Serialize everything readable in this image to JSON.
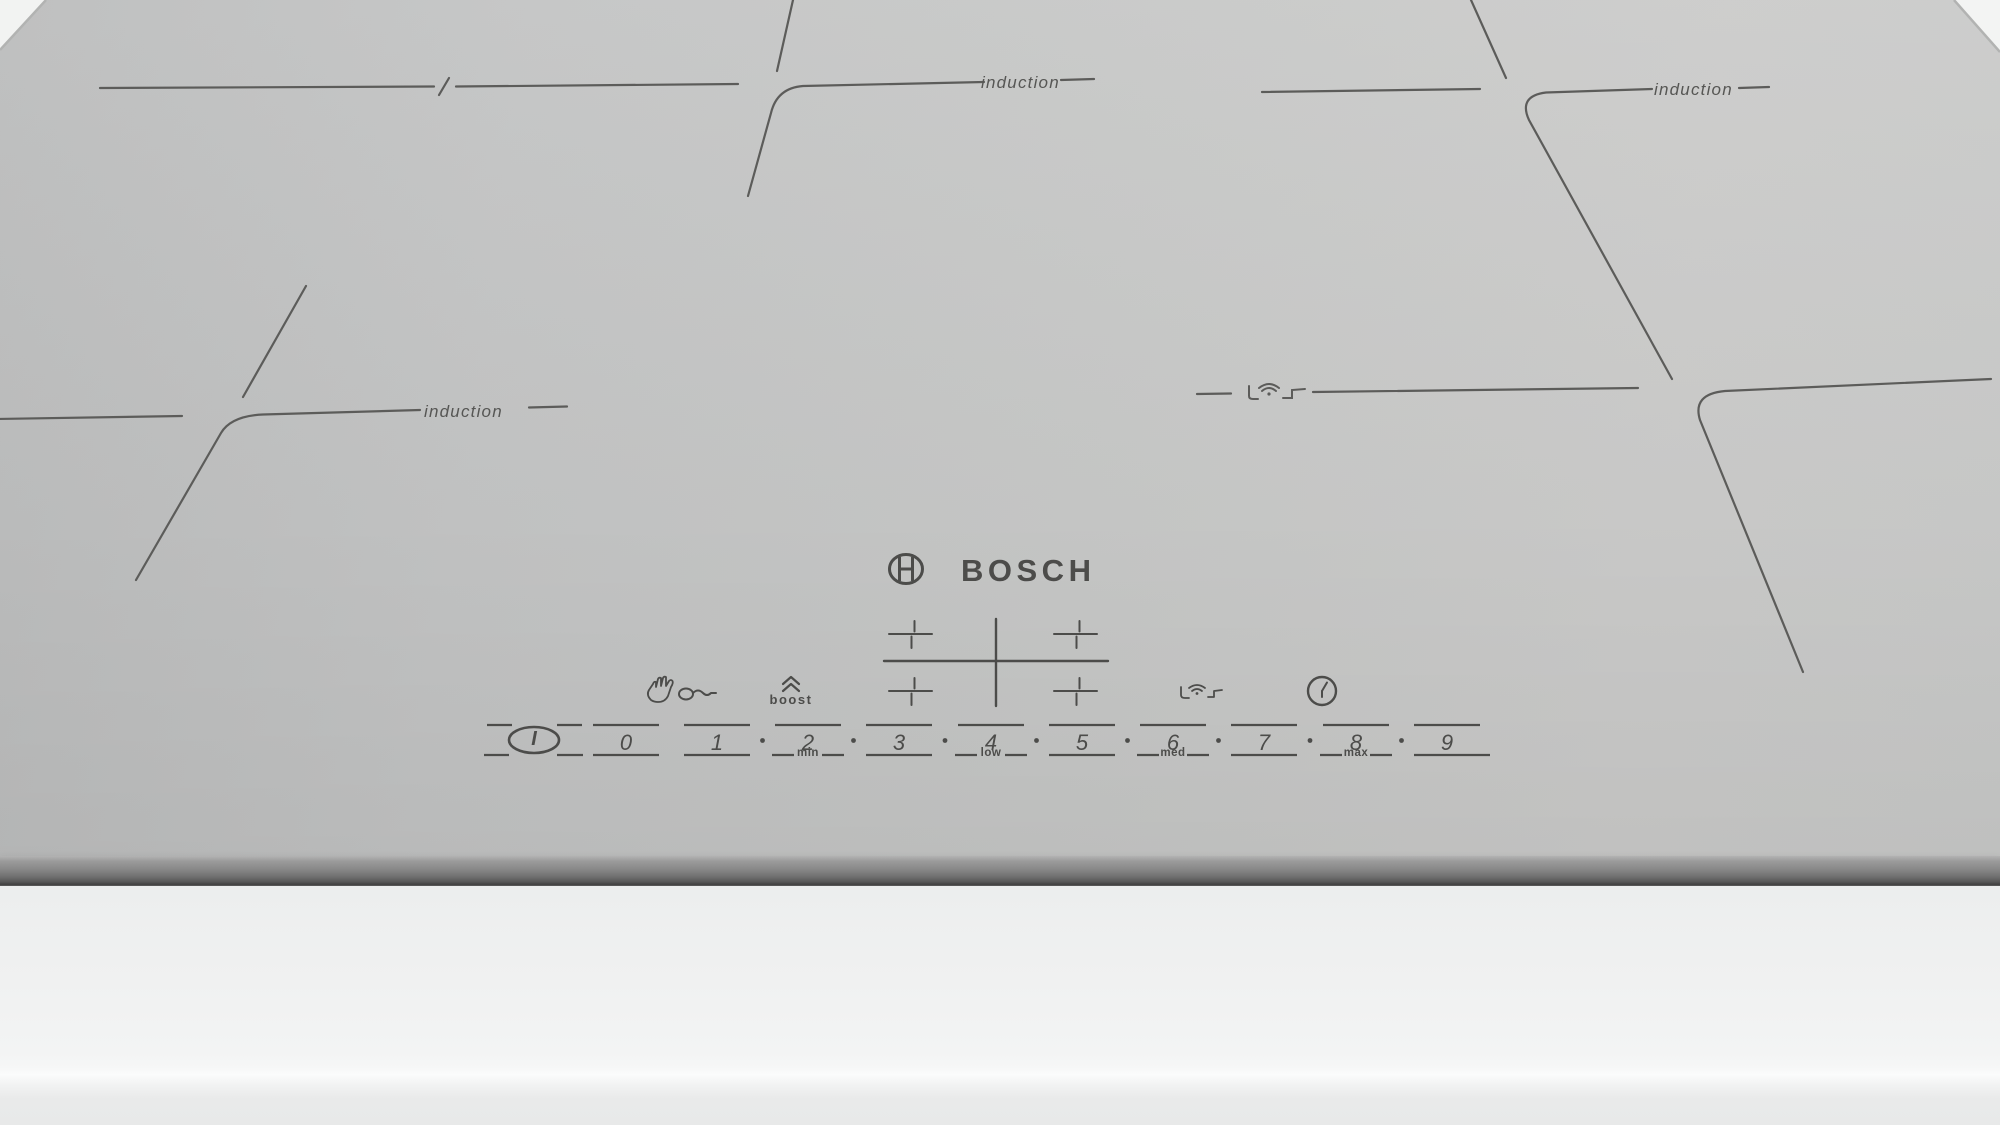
{
  "brand": {
    "name": "BOSCH"
  },
  "zones": {
    "labels": [
      "induction",
      "induction",
      "induction"
    ]
  },
  "controls": {
    "boost_label": "boost",
    "icon_names": [
      "hand-icon",
      "key-icon",
      "boost-chevrons-icon",
      "zone-select-cross",
      "pan-detection-icon",
      "timer-clock-icon",
      "flex-zone-pan-icon",
      "power-button"
    ]
  },
  "slider": {
    "power_label": "I",
    "digits": [
      "0",
      "1",
      "2",
      "3",
      "4",
      "5",
      "6",
      "7",
      "8",
      "9"
    ],
    "scale_labels": [
      "min",
      "low",
      "med",
      "max"
    ]
  },
  "colors": {
    "glass": "#c5c6c5",
    "marking": "#5c5c5a",
    "control": "#4c4c4a",
    "front_panel": "#f0f1f1"
  }
}
